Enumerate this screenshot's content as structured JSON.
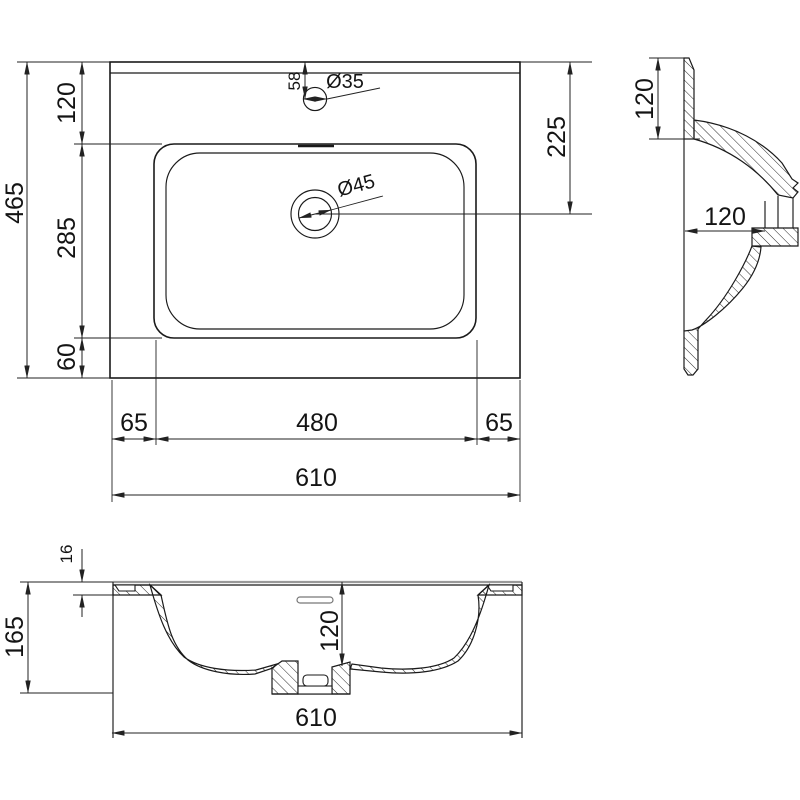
{
  "drawing_title": "washbasin-technical-drawing",
  "colors": {
    "line": "#1a1a1a",
    "dim": "#222222",
    "background": "#ffffff",
    "surface_gray": "#999999"
  },
  "plan": {
    "overall_depth": "465",
    "back_depth": "120",
    "basin_depth": "285",
    "front_margin": "60",
    "faucet_offset": "58",
    "faucet_diameter": "Ø35",
    "drain_diameter": "Ø45",
    "drain_from_top": "225",
    "left_margin": "65",
    "basin_width": "480",
    "right_margin": "65",
    "overall_width": "610"
  },
  "side_section": {
    "deck_height": "120",
    "deck_depth": "120"
  },
  "front_section": {
    "rim_thickness": "16",
    "overall_height": "165",
    "bowl_depth": "120",
    "overall_width": "610"
  }
}
